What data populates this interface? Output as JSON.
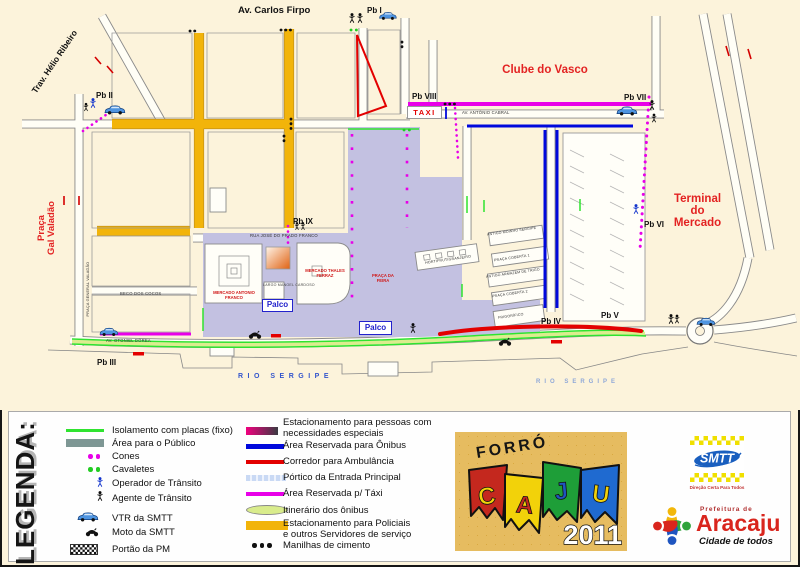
{
  "map": {
    "streets": {
      "av_carlos_firpo": "Av. Carlos Firpo",
      "trav_helio_ribeiro": "Trav. Hélio Ribeiro",
      "av_antonio_cabral": "AV. ANTÔNIO CABRAL",
      "rua_jose_do_prado_franco": "RUA JOSÉ DO PRADO FRANCO",
      "beco_dos_cocos": "BECO DOS COCOS",
      "av_otoniel_dorea": "AV. OTONIEL DÓREA",
      "praca_general_valadao": "PRAÇA GENERAL VALADÃO"
    },
    "areas": {
      "clube_do_vasco": "Clube do Vasco",
      "terminal_do_mercado": "Terminal\ndo\nMercado",
      "praca_gal_valadao": "Praça\nGal Valadão",
      "rio_sergipe_left": "RIO SERGIPE",
      "rio_sergipe_right": "RIO SERGIPE"
    },
    "points": [
      "Pb I",
      "Pb II",
      "Pb III",
      "Pb IV",
      "Pb V",
      "Pb VI",
      "Pb VII",
      "Pb VIII",
      "Pb IX"
    ],
    "signs": {
      "taxi": "TAXI",
      "palco": "Palco"
    },
    "buildings": {
      "mercado_antonio_franco": "MERCADO ANTONIO FRANCO",
      "mercado_thales_ferraz": "MERCADO THALES\nFERRAZ",
      "praca_da_feira": "PRAÇA DA\nFEIRA",
      "largo": "LARGO\nMANOEL\nCARDOSO",
      "hortifrutigranjeiro": "HORTIFRUTIGRANJEIRO",
      "antigo_moinho_sergipe": "ANTIGO MOINHO SERGIPE",
      "praca_coberta_1": "PRAÇA COBERTA 1",
      "antigo_armazem_de_trigo": "ANTIGO ARMAZÉM DE TRIGO",
      "praca_coberta_2": "PRAÇA COBERTA 2",
      "frigorifico": "FRIGORÍFICO"
    }
  },
  "legend": {
    "title": "LEGENDA:",
    "col1": [
      {
        "label": "Isolamento com placas (fixo)",
        "icon": "green-line"
      },
      {
        "label": "Área para o Público",
        "icon": "gray-area"
      },
      {
        "label": "Cones",
        "icon": "magenta-dots"
      },
      {
        "label": "Cavaletes",
        "icon": "green-dots"
      },
      {
        "label": "Operador de Trânsito",
        "icon": "blue-person"
      },
      {
        "label": "Agente de Trânsito",
        "icon": "black-person"
      },
      {
        "label": "VTR da SMTT",
        "icon": "blue-car"
      },
      {
        "label": "Moto da SMTT",
        "icon": "motorcycle"
      },
      {
        "label": "Portão da PM",
        "icon": "checkered-gate"
      }
    ],
    "col2": [
      {
        "label": "Estacionamento para pessoas com\nnecessidades especiais",
        "icon": "gradient-bar"
      },
      {
        "label": "Área Reservada para Ônibus",
        "icon": "blue-bar"
      },
      {
        "label": "Corredor para Ambulância",
        "icon": "red-bar"
      },
      {
        "label": "Pórtico da Entrada Principal",
        "icon": "lightblue-dashes"
      },
      {
        "label": "Área Reservada p/ Táxi",
        "icon": "magenta-bar"
      },
      {
        "label": "Itinerário dos ônibus",
        "icon": "lightgreen-oval"
      },
      {
        "label": "Estacionamento para Policiais\ne outros Servidores de serviço",
        "icon": "yellow-bar"
      },
      {
        "label": "Manilhas de cimento",
        "icon": "black-dots"
      }
    ]
  },
  "logos": {
    "forro": {
      "title": "FORRÓ",
      "letters": [
        "C",
        "A",
        "J",
        "U"
      ],
      "year": "2011"
    },
    "smtt": {
      "name": "SMTT",
      "tagline": "Direção Certa Para Todos"
    },
    "prefeitura": {
      "line1": "Prefeitura de",
      "name": "Aracaju",
      "tagline": "Cidade de todos"
    }
  },
  "colors": {
    "background": "#FCF3DB",
    "public_area": "#C3C1E1",
    "isolation_green": "#2FE32F",
    "bus_blue": "#0008DC",
    "ambulance_red": "#E30000",
    "taxi_magenta": "#E800E8",
    "police_yellow": "#F2B40A",
    "legend_public_gray": "#7E9794",
    "red_label": "#E32222",
    "palco_blue": "#2222CC"
  }
}
